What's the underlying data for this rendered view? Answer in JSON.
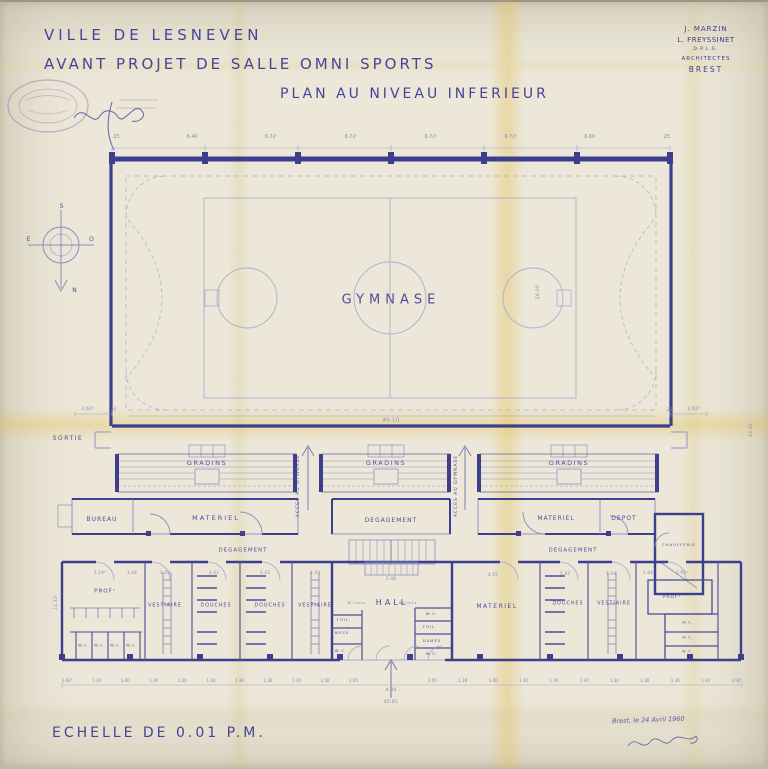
{
  "doc": {
    "title_line1": "VILLE DE LESNEVEN",
    "title_line2": "AVANT PROJET DE SALLE OMNI SPORTS",
    "title_line3": "PLAN AU NIVEAU INFERIEUR",
    "scale_note": "ECHELLE DE 0.01 P.M.",
    "date_note": "Brest, le 24 Avril 1960"
  },
  "architects": {
    "line1": "J. MARZIN",
    "line2": "L. FREYSSINET",
    "line3": "D.P.L.G.",
    "line4": "ARCHITECTES",
    "line5": "BREST"
  },
  "compass": {
    "top": "S",
    "left": "E",
    "right": "O",
    "bottom": "N"
  },
  "plan": {
    "gym": "GYMNASE",
    "sortie": "SORTIE",
    "gradins": [
      "GRADINS",
      "GRADINS",
      "GRADINS"
    ],
    "acces": [
      "ACCES AU GYMNASE",
      "ACCES AU GYMNASE"
    ],
    "rooms": {
      "bureau": "BUREAU",
      "materiel": "MATERIEL",
      "degagement": "DEGAGEMENT",
      "depot": "DEPOT",
      "chaufferie": "CHAUFFERIE",
      "prof": "PROFˢ",
      "vestiaire": "VESTIAIRE",
      "douches": "DOUCHES",
      "hall": "HALL",
      "billets": "Billets",
      "toil": "TOIL.",
      "mess": "MESS",
      "dames": "DAMES",
      "wc": "W.C."
    }
  },
  "dims": {
    "top_row": [
      ".25",
      "6.40",
      "6.72⁵",
      "6.72⁵",
      "6.72⁵",
      "6.72⁵",
      "6.60",
      ".25"
    ],
    "gym_width": "40.10",
    "gym_depth": "26.00",
    "gym_side_left": "2.62⁵",
    "gym_side_right": "2.62⁵",
    "wall": ".25",
    "stairs_width": "2.48",
    "entrance_width": "4.30",
    "total_width": "45.85",
    "left_rooms": [
      "2.19⁵",
      "1.44",
      "3.43",
      "3.43",
      "3.43",
      "3.43"
    ],
    "right_rooms": [
      "4.55",
      "3.43",
      "3.43",
      "1.44",
      "2.92⁵"
    ],
    "left_height": "11.32⁵",
    "right_edge_height": "33.32",
    "chain_left": [
      "2.92⁵",
      "1.30",
      "1.30",
      "1.30",
      "1.30",
      "1.30",
      "1.30",
      "1.30",
      "1.30",
      "1.50",
      "2.05"
    ],
    "chain_right": [
      "2.05",
      "1.30",
      "1.30",
      "1.30",
      "1.30",
      "1.30",
      "1.30",
      "1.30",
      "1.30",
      "1.30",
      "2.92⁵"
    ]
  },
  "colors": {
    "paper": "#ece7d8",
    "ink": "#4d4c9c",
    "wall": "#3d3e8c",
    "faint_line": "#9095c6",
    "aging_yellow": "#e4c45a",
    "stamp_violet": "#8a6fb0"
  }
}
